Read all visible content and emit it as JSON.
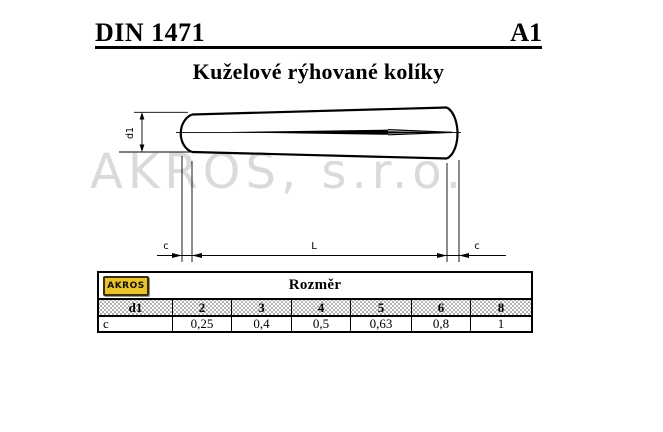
{
  "header": {
    "standard": "DIN 1471",
    "revision": "A1"
  },
  "title": "Kuželové rýhované kolíky",
  "watermark": "AKROS, s.r.o.",
  "drawing": {
    "labels": {
      "d1": "d1",
      "L": "L",
      "c_left": "c",
      "c_right": "c"
    }
  },
  "table": {
    "logo": "AKROS",
    "logo_color": "#e8c32e",
    "title": "Rozměr",
    "columns": [
      "d1",
      "2",
      "3",
      "4",
      "5",
      "6",
      "8"
    ],
    "rows": [
      {
        "label": "c",
        "values": [
          "0,25",
          "0,4",
          "0,5",
          "0,63",
          "0,8",
          "1"
        ]
      }
    ]
  }
}
